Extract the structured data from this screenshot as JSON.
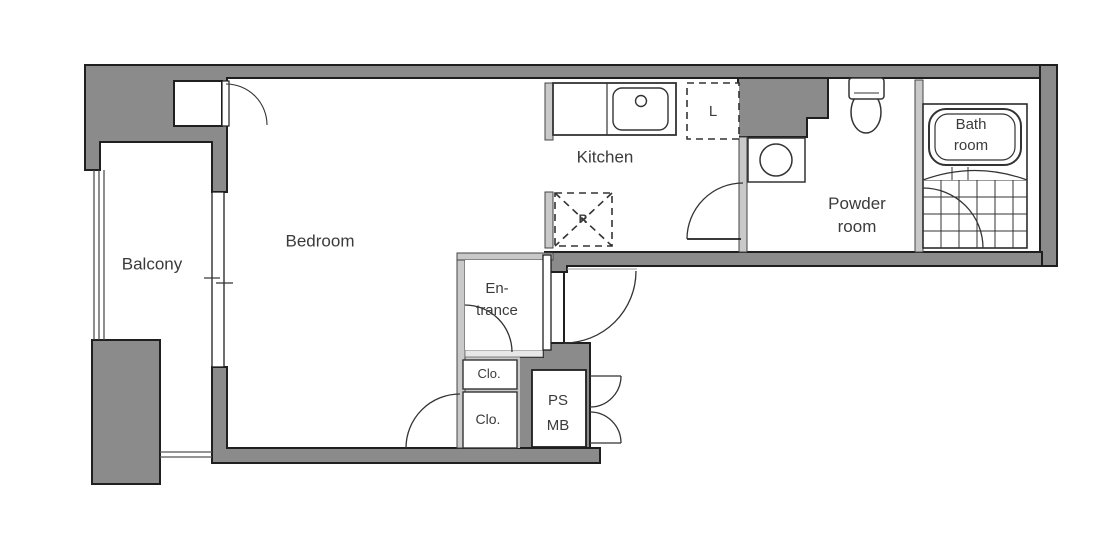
{
  "title": "Apartment floor plan",
  "rooms": {
    "balcony": "Balcony",
    "bedroom": "Bedroom",
    "kitchen": "Kitchen",
    "powder_room_line1": "Powder",
    "powder_room_line2": "room",
    "bath_room_line1": "Bath",
    "bath_room_line2": "room",
    "entrance_line1": "En-",
    "entrance_line2": "trance",
    "closet_upper": "Clo.",
    "closet_lower": "Clo.",
    "ps_label": "PS",
    "mb_label": "MB",
    "laundry_label": "L",
    "refrigerator_label": "R"
  },
  "fixtures": [
    "kitchen-counter",
    "kitchen-sink",
    "sink-faucet-circle",
    "washing-machine",
    "toilet",
    "bathtub",
    "bath-tile-floor",
    "sliding-window",
    "balcony-railing",
    "entrance-step",
    "meter-box-double-doors",
    "door-swing-arcs"
  ],
  "colors": {
    "wall_fill": "#8b8b8b",
    "wall_outline": "#1f1f1f",
    "thin_wall_fill": "#c9c9c9",
    "line": "#333333",
    "text": "#3b3b3b",
    "background": "#ffffff"
  }
}
